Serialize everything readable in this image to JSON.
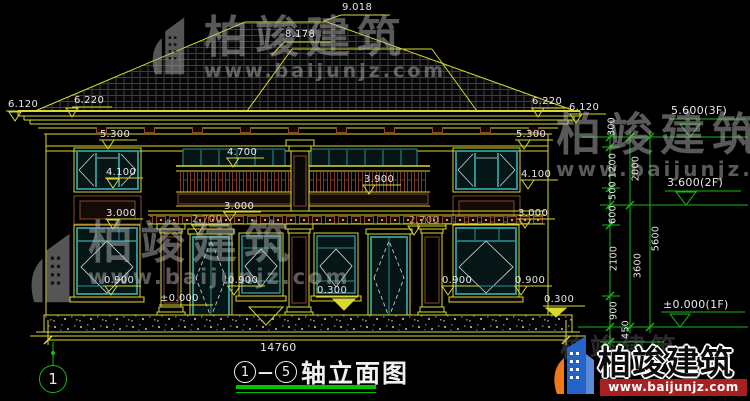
{
  "watermark": {
    "brand": "柏竣建筑",
    "url": "www.baijunjz.com"
  },
  "footer_logo": {
    "brand": "柏竣建筑",
    "url": "www.baijunjz.com"
  },
  "title_block": {
    "axis_start": "1",
    "separator": "—",
    "axis_end": "5",
    "name": "轴立面图"
  },
  "axis_bubble": {
    "label": "1"
  },
  "overall_dim": {
    "width": "14760"
  },
  "elevations": {
    "ridge": "9.018",
    "sub_ridge": "8.178",
    "left": {
      "eave_outer": "6.120",
      "eave": "6.220",
      "l53": "5.300",
      "l41": "4.100",
      "l30": "3.000",
      "l09": "0.900"
    },
    "center": {
      "c47": "4.700",
      "c39": "3.900",
      "c30": "3.000",
      "c27l": "2.700",
      "c27r": "2.700",
      "c09": "0.900",
      "c09r": "0.900",
      "c03": "0.300",
      "c00": "±0.000"
    },
    "right": {
      "eave": "6.220",
      "eave_outer": "6.120",
      "r53": "5.300",
      "r41": "4.100",
      "r30": "3.000",
      "r09": "0.900",
      "r03": "0.300"
    }
  },
  "dim_chain": {
    "segments": [
      "300",
      "1200",
      "500",
      "600",
      "2100",
      "900",
      "450"
    ],
    "subtotals": [
      "2000",
      "3600"
    ],
    "total": "5600",
    "levels": [
      "5.600(3F)",
      "3.600(2F)",
      "±0.000(1F)"
    ]
  }
}
